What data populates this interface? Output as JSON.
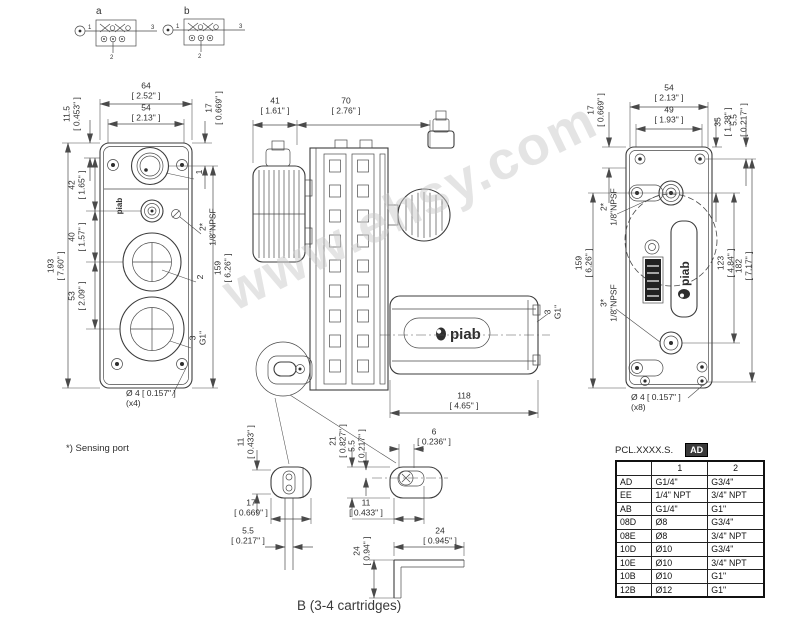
{
  "watermark": "www.ehsy.com",
  "schematics": {
    "a_label": "a",
    "b_label": "b",
    "port1": "1",
    "port2": "2",
    "port3": "3"
  },
  "logos": {
    "piab": "piab"
  },
  "notes": {
    "sensing_port": "*) Sensing port",
    "caption": "B (3-4 cartridges)"
  },
  "views": {
    "front": {
      "dims": {
        "w64": {
          "mm": "64",
          "in": "[ 2.52\" ]"
        },
        "w54": {
          "mm": "54",
          "in": "[ 2.13\" ]"
        },
        "h115": {
          "mm": "11.5",
          "in": "[ 0.453\" ]"
        },
        "h17": {
          "mm": "17",
          "in": "[ 0.669\" ]"
        },
        "h42": {
          "mm": "42",
          "in": "[ 1.65\" ]"
        },
        "h40": {
          "mm": "40",
          "in": "[ 1.57\" ]"
        },
        "h53": {
          "mm": "53",
          "in": "[ 2.09\" ]"
        },
        "h193": {
          "mm": "193",
          "in": "[ 7.60\" ]"
        },
        "h159": {
          "mm": "159",
          "in": "[ 6.26\" ]"
        },
        "hole": {
          "text": "Ø 4 [ 0.157\" ]",
          "qty": "(x4)"
        }
      },
      "ports": {
        "p1": "1",
        "p2s": {
          "l1": "2*",
          "l2": "1/8\"NPSF"
        },
        "p2": "2",
        "p3": {
          "l1": "3",
          "l2": "G1\""
        }
      }
    },
    "side": {
      "dims": {
        "w41": {
          "mm": "41",
          "in": "[ 1.61\" ]"
        },
        "w70": {
          "mm": "70",
          "in": "[ 2.76\" ]"
        },
        "w118": {
          "mm": "118",
          "in": "[ 4.65\" ]"
        }
      },
      "ports": {
        "p3": {
          "l1": "3",
          "l2": "G1\""
        }
      }
    },
    "back": {
      "dims": {
        "w54": {
          "mm": "54",
          "in": "[ 2.13\" ]"
        },
        "w49": {
          "mm": "49",
          "in": "[ 1.93\" ]"
        },
        "h17": {
          "mm": "17",
          "in": "[ 0.669\" ]"
        },
        "h35": {
          "mm": "35",
          "in": "[ 1.38\" ]"
        },
        "h55": {
          "mm": "5.5",
          "in": "[ 0.217\" ]"
        },
        "h159": {
          "mm": "159",
          "in": "[ 6.26\" ]"
        },
        "h123": {
          "mm": "123",
          "in": "[ 4.84\" ]"
        },
        "h182": {
          "mm": "182",
          "in": "[ 7.17\" ]"
        },
        "hole": {
          "text": "Ø 4 [ 0.157\" ]",
          "qty": "(x8)"
        }
      },
      "ports": {
        "p2s": {
          "l1": "2*",
          "l2": "1/8\"NPSF"
        },
        "p3s": {
          "l1": "3*",
          "l2": "1/8\"NPSF"
        }
      }
    },
    "bracket": {
      "dims": {
        "d11a": {
          "mm": "11",
          "in": "[ 0.433\" ]"
        },
        "d17": {
          "mm": "17",
          "in": "[ 0.669\" ]"
        },
        "d55a": {
          "mm": "5.5",
          "in": "[ 0.217\" ]"
        },
        "d21": {
          "mm": "21",
          "in": "[ 0.827\" ]"
        },
        "d55b": {
          "mm": "5.5",
          "in": "[ 0.217\" ]"
        },
        "d6": {
          "mm": "6",
          "in": "[ 0.236\" ]"
        },
        "d11b": {
          "mm": "11",
          "in": "[ 0.433\" ]"
        },
        "d24v": {
          "mm": "24",
          "in": "[ 0.94\" ]"
        },
        "d24h": {
          "mm": "24",
          "in": "[ 0.945\" ]"
        }
      }
    }
  },
  "table": {
    "title": "PCL.XXXX.S.",
    "badge": "AD",
    "headers": [
      "",
      "1",
      "2"
    ],
    "rows": [
      [
        "AD",
        "G1/4\"",
        "G3/4\""
      ],
      [
        "EE",
        "1/4\" NPT",
        "3/4\" NPT"
      ],
      [
        "AB",
        "G1/4\"",
        "G1\""
      ],
      [
        "08D",
        "Ø8",
        "G3/4\""
      ],
      [
        "08E",
        "Ø8",
        "3/4\" NPT"
      ],
      [
        "10D",
        "Ø10",
        "G3/4\""
      ],
      [
        "10E",
        "Ø10",
        "3/4\" NPT"
      ],
      [
        "10B",
        "Ø10",
        "G1\""
      ],
      [
        "12B",
        "Ø12",
        "G1\""
      ]
    ]
  },
  "colors": {
    "line": "#3c3c3c",
    "watermark": "#cacaca",
    "badge_bg": "#3a3a3a"
  }
}
